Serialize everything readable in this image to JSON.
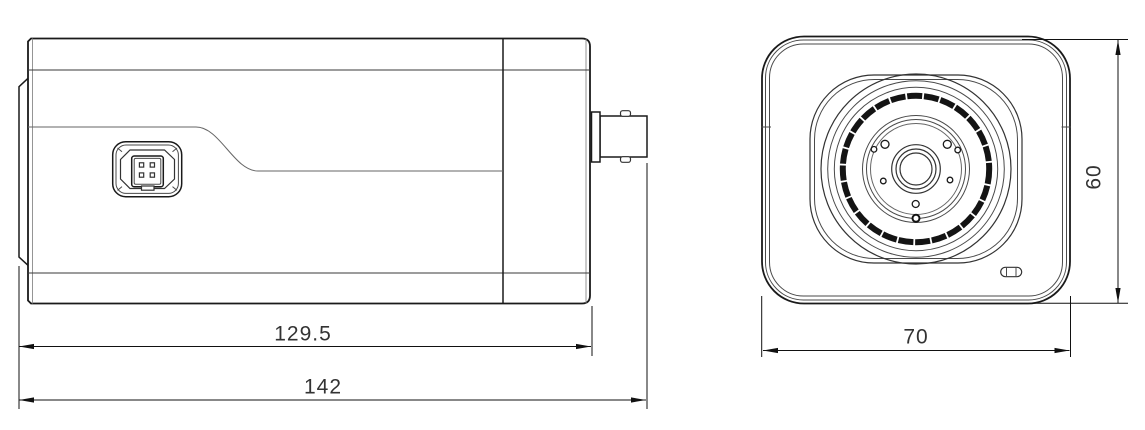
{
  "drawing": {
    "type": "technical_dimension_drawing",
    "subject": "box camera orthographic views (side view and front view)",
    "background_color": "#ffffff",
    "line_color": "#1a1a1a",
    "dim_text_color": "#333333"
  },
  "dimensions": {
    "body_length": "129.5",
    "total_length": "142",
    "front_width": "70",
    "front_height": "60"
  },
  "icons": {
    "side_view": "camera-side-profile",
    "front_view": "camera-front-face",
    "connector_side": "4-pin-socket",
    "connector_rear": "bnc-connector",
    "indicator": "led-window"
  }
}
